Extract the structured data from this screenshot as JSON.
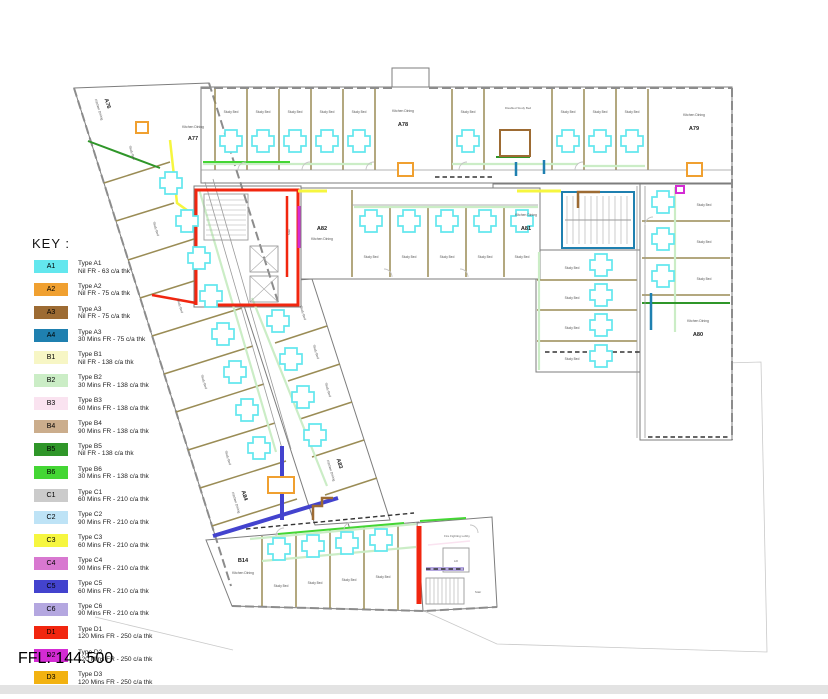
{
  "key": {
    "title": "KEY :",
    "items": [
      {
        "code": "A1",
        "color": "#63E7EE",
        "line1": "Type A1",
        "line2": "Nil FR - 63 c/a thk"
      },
      {
        "code": "A2",
        "color": "#F0A030",
        "line1": "Type A2",
        "line2": "Nil FR - 75 c/a thk"
      },
      {
        "code": "A3",
        "color": "#9D6B33",
        "line1": "Type A3",
        "line2": "Nil FR - 75 c/a thk"
      },
      {
        "code": "A4",
        "color": "#1F80B0",
        "line1": "Type A3",
        "line2": "30 Mins FR - 75 c/a thk"
      },
      {
        "code": "B1",
        "color": "#F7F6C5",
        "line1": "Type B1",
        "line2": "Nil FR - 138 c/a thk"
      },
      {
        "code": "B2",
        "color": "#CBEDC6",
        "line1": "Type B2",
        "line2": "30 Mins FR - 138 c/a thk"
      },
      {
        "code": "B3",
        "color": "#FAE3F0",
        "line1": "Type B3",
        "line2": "60 Mins FR - 138 c/a thk"
      },
      {
        "code": "B4",
        "color": "#CBAD8C",
        "line1": "Type B4",
        "line2": "90 Mins FR - 138 c/a thk"
      },
      {
        "code": "B5",
        "color": "#2F9629",
        "line1": "Type B5",
        "line2": "Nil FR - 138 c/a thk"
      },
      {
        "code": "B6",
        "color": "#44D634",
        "line1": "Type B6",
        "line2": "30 Mins FR - 138 c/a thk"
      },
      {
        "code": "C1",
        "color": "#CBCBCB",
        "line1": "Type C1",
        "line2": "60 Mins FR - 210 c/a thk"
      },
      {
        "code": "C2",
        "color": "#BEE3F6",
        "line1": "Type C2",
        "line2": "90 Mins FR - 210 c/a thk"
      },
      {
        "code": "C3",
        "color": "#F6F63F",
        "line1": "Type C3",
        "line2": "60 Mins FR - 210 c/a thk"
      },
      {
        "code": "C4",
        "color": "#D878D0",
        "line1": "Type C4",
        "line2": "90 Mins FR - 210 c/a thk"
      },
      {
        "code": "C5",
        "color": "#4343CE",
        "line1": "Type C5",
        "line2": "60 Mins FR - 210 c/a thk"
      },
      {
        "code": "C6",
        "color": "#B4A7E0",
        "line1": "Type C6",
        "line2": "90 Mins FR - 210 c/a thk"
      },
      {
        "code": "D1",
        "color": "#F1260F",
        "line1": "Type D1",
        "line2": "120 Mins FR - 250 c/a thk"
      },
      {
        "code": "D2",
        "color": "#D42BD4",
        "line1": "Type D2",
        "line2": "120 Mins FR - 250 c/a thk"
      },
      {
        "code": "D3",
        "color": "#F2B211",
        "line1": "Type D3",
        "line2": "120 Mins FR - 250 c/a thk"
      }
    ]
  },
  "ffl": "FFL: 144.500",
  "plan": {
    "units": {
      "a76": "A76",
      "a77": "A77",
      "a78": "A78",
      "a79": "A79",
      "a80": "A80",
      "a81": "A81",
      "a82": "A82",
      "a83": "A83",
      "a84": "A84",
      "b14": "B14"
    },
    "labels": {
      "kitchen_dining": "Kitchen Dining",
      "study_bed": "Study Bed",
      "disabled_study_bed": "Disabled Study Bed",
      "fire_fighting_lobby": "Fire Fighting Lobby",
      "lift": "Lift",
      "stair": "Stair"
    }
  }
}
